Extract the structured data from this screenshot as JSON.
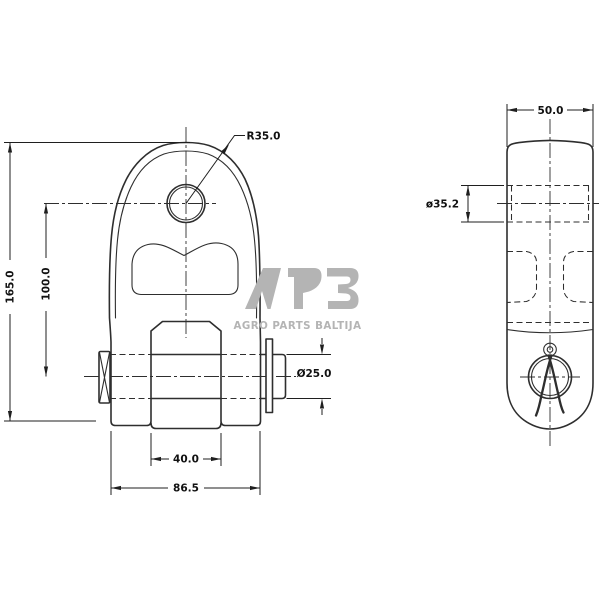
{
  "watermark": {
    "brand": "APB",
    "subtitle": "AGRO PARTS BALTIJA",
    "color": "#b4b4b4"
  },
  "views": {
    "front": {
      "dims": {
        "overall_height": "165.0",
        "hole_to_pin_center": "100.0",
        "top_radius": "R35.0",
        "pin_diameter": "Ø25.0",
        "jaw_opening": "40.0",
        "overall_width": "86.5"
      }
    },
    "side": {
      "dims": {
        "width": "50.0",
        "bore_diameter": "ø35.2"
      }
    }
  },
  "colors": {
    "line": "#2e2e2e",
    "dimension_text": "#111111",
    "watermark_gray": "#b4b4b4",
    "background": "#ffffff"
  }
}
